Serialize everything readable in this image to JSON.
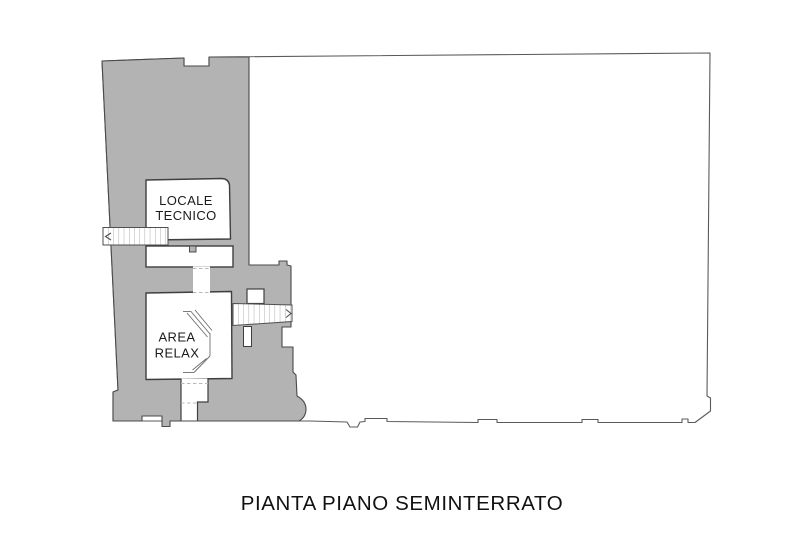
{
  "plan": {
    "title": "PIANTA PIANO SEMINTERRATO",
    "rooms": [
      {
        "id": "locale-tecnico",
        "label_line1": "LOCALE",
        "label_line2": "TECNICO"
      },
      {
        "id": "area-relax",
        "label_line1": "AREA",
        "label_line2": "RELAX"
      }
    ],
    "icons": {
      "stair_arrow_left": "chevron-left-icon",
      "stair_arrow_right": "chevron-right-icon"
    },
    "colors": {
      "highlight_gray": "#b3b3b3",
      "outline_dark": "#3f3f3f",
      "outline_light": "#5a5a5a",
      "background": "#ffffff"
    }
  }
}
